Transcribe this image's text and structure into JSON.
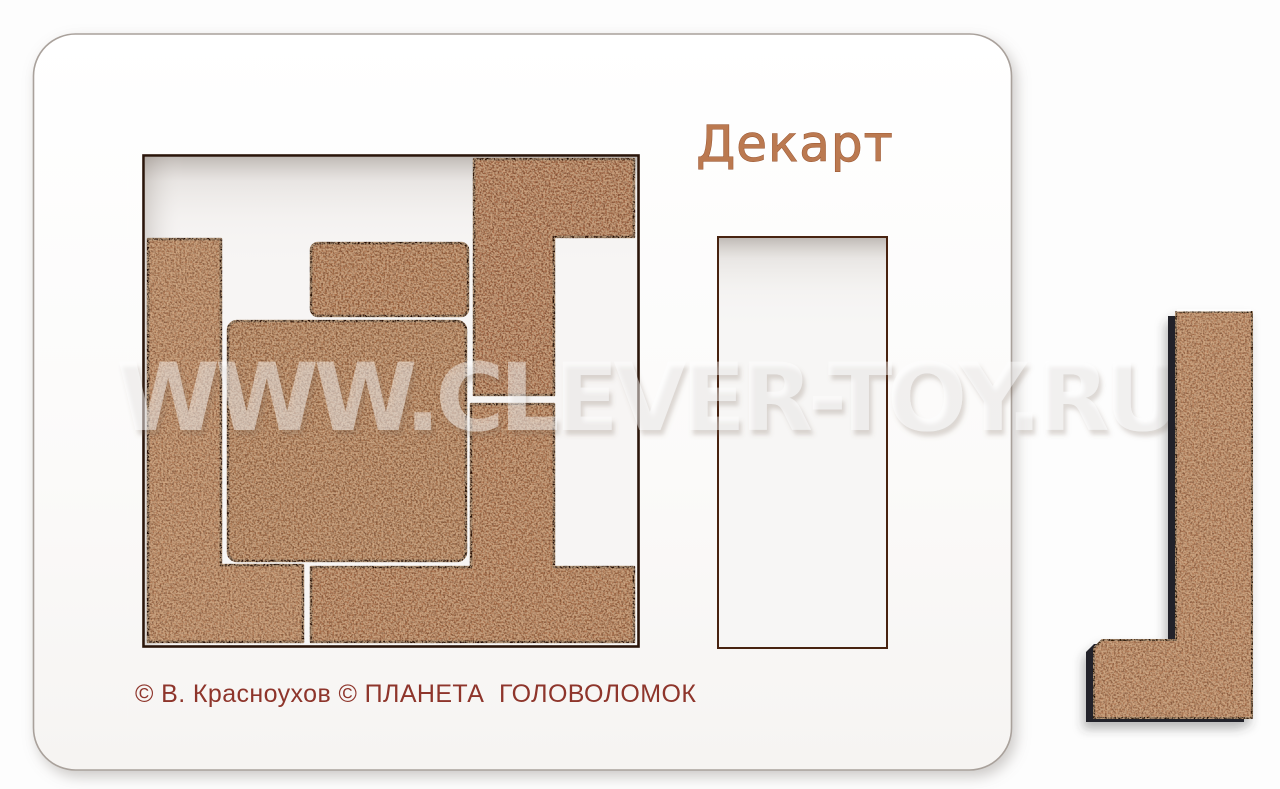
{
  "photo": {
    "board_title": "Декарт",
    "copyright_line": "© В. Красноухов © ПЛАНЕТА  ГОЛОВОЛОМОК",
    "watermark": "WWW.CLEVER-TOY.RU"
  },
  "scene": {
    "object": "wooden puzzle board with pieces",
    "pieces_in_tray": 5,
    "loose_pieces": 1,
    "loose_piece_shape": "L-shape",
    "empty_cutout": "vertical rectangle slot"
  },
  "colors": {
    "background": "#fdfdfd",
    "board_white": "#fcfbfa",
    "tray_floor": "#f5f3f2",
    "piece_brown": "#aa7150",
    "piece_edge_dark": "#1a0d06",
    "title_text": "#b8774f",
    "copyright_text": "#8e352b",
    "watermark": "#ffffff"
  }
}
